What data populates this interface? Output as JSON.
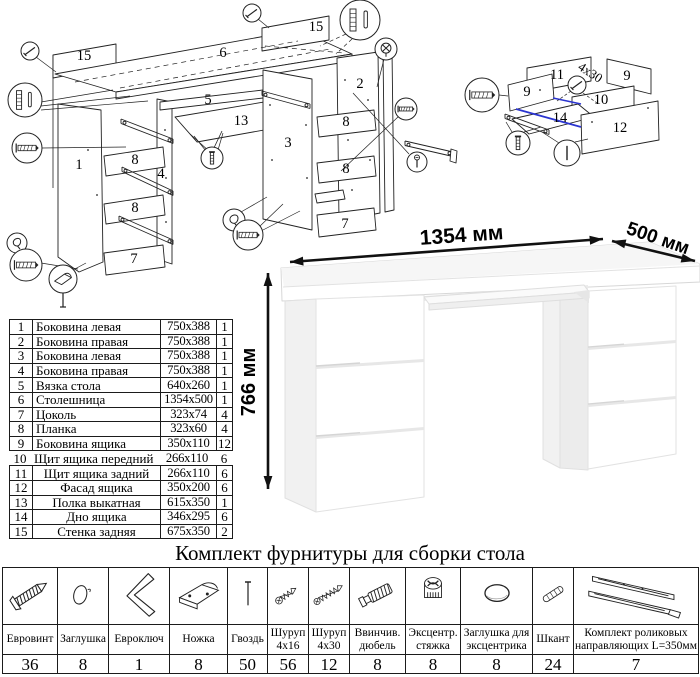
{
  "title": {
    "text": "Комплект фурнитуры для сборки стола"
  },
  "dimensions": {
    "width": "1354 мм",
    "depth": "500 мм",
    "height": "766 мм"
  },
  "parts_table": {
    "rows": [
      {
        "num": "1",
        "name": "Боковина левая",
        "size": "750x388",
        "qty": "1"
      },
      {
        "num": "2",
        "name": "Боковина правая",
        "size": "750x388",
        "qty": "1"
      },
      {
        "num": "3",
        "name": "Боковина левая",
        "size": "750x388",
        "qty": "1"
      },
      {
        "num": "4",
        "name": "Боковина правая",
        "size": "750x388",
        "qty": "1"
      },
      {
        "num": "5",
        "name": "Вязка стола",
        "size": "640x260",
        "qty": "1"
      },
      {
        "num": "6",
        "name": "Столешница",
        "size": "1354x500",
        "qty": "1"
      },
      {
        "num": "7",
        "name": "Цоколь",
        "size": "323x74",
        "qty": "4"
      },
      {
        "num": "8",
        "name": "Планка",
        "size": "323x60",
        "qty": "4"
      },
      {
        "num": "9",
        "name": "Боковина ящика",
        "size": "350x110",
        "qty": "12"
      },
      {
        "num": "10",
        "name": "Щит ящика передний",
        "size": "266x110",
        "qty": "6"
      },
      {
        "num": "11",
        "name": "Щит ящика задний",
        "size": "266x110",
        "qty": "6"
      },
      {
        "num": "12",
        "name": "Фасад ящика",
        "size": "350x200",
        "qty": "6"
      },
      {
        "num": "13",
        "name": "Полка выкатная",
        "size": "615x350",
        "qty": "1"
      },
      {
        "num": "14",
        "name": "Дно ящика",
        "size": "346x295",
        "qty": "6"
      },
      {
        "num": "15",
        "name": "Стенка задняя",
        "size": "675x350",
        "qty": "2"
      }
    ]
  },
  "hardware_table": {
    "columns": [
      {
        "icon": "euro-screw",
        "name": "Евровинт",
        "qty": "36"
      },
      {
        "icon": "plug",
        "name": "Заглушка",
        "qty": "8"
      },
      {
        "icon": "hex-key",
        "name": "Евроключ",
        "qty": "1"
      },
      {
        "icon": "furniture-leg",
        "name": "Ножка",
        "qty": "8"
      },
      {
        "icon": "nail",
        "name": "Гвоздь",
        "qty": "50"
      },
      {
        "icon": "screw-4x16",
        "name": "Шуруп 4x16",
        "qty": "56"
      },
      {
        "icon": "screw-4x30",
        "name": "Шуруп 4x30",
        "qty": "12"
      },
      {
        "icon": "dowel-screw",
        "name": "Ввинчив. дюбель",
        "qty": "8"
      },
      {
        "icon": "cam-lock",
        "name": "Эксцентр. стяжка",
        "qty": "8"
      },
      {
        "icon": "cam-cover",
        "name": "Заглушка для эксцентрика",
        "qty": "8"
      },
      {
        "icon": "wood-dowel",
        "name": "Шкант",
        "qty": "24"
      },
      {
        "icon": "drawer-slides",
        "name": "Комплект роликовых направляющих L=350мм",
        "qty": "7"
      }
    ]
  },
  "exploded_views": {
    "main_labels": [
      {
        "text": "15",
        "x": 84,
        "y": 60
      },
      {
        "text": "6",
        "x": 223,
        "y": 57
      },
      {
        "text": "15",
        "x": 316,
        "y": 31
      },
      {
        "text": "5",
        "x": 208,
        "y": 104
      },
      {
        "text": "13",
        "x": 241,
        "y": 125
      },
      {
        "text": "3",
        "x": 288,
        "y": 147
      },
      {
        "text": "1",
        "x": 79,
        "y": 169
      },
      {
        "text": "4",
        "x": 161,
        "y": 178
      },
      {
        "text": "8",
        "x": 135,
        "y": 164
      },
      {
        "text": "8",
        "x": 135,
        "y": 212
      },
      {
        "text": "7",
        "x": 134,
        "y": 263
      },
      {
        "text": "2",
        "x": 360,
        "y": 88
      },
      {
        "text": "8",
        "x": 346,
        "y": 126
      },
      {
        "text": "8",
        "x": 346,
        "y": 173
      },
      {
        "text": "7",
        "x": 345,
        "y": 228
      }
    ],
    "drawer_labels": [
      {
        "text": "11",
        "x": 557,
        "y": 79
      },
      {
        "text": "9",
        "x": 527,
        "y": 96
      },
      {
        "text": "9",
        "x": 627,
        "y": 80
      },
      {
        "text": "10",
        "x": 601,
        "y": 104
      },
      {
        "text": "14",
        "x": 560,
        "y": 122
      },
      {
        "text": "12",
        "x": 620,
        "y": 132
      }
    ],
    "screw_note": {
      "text": "4x30",
      "x": 588,
      "y": 76,
      "rotate": 33
    }
  }
}
